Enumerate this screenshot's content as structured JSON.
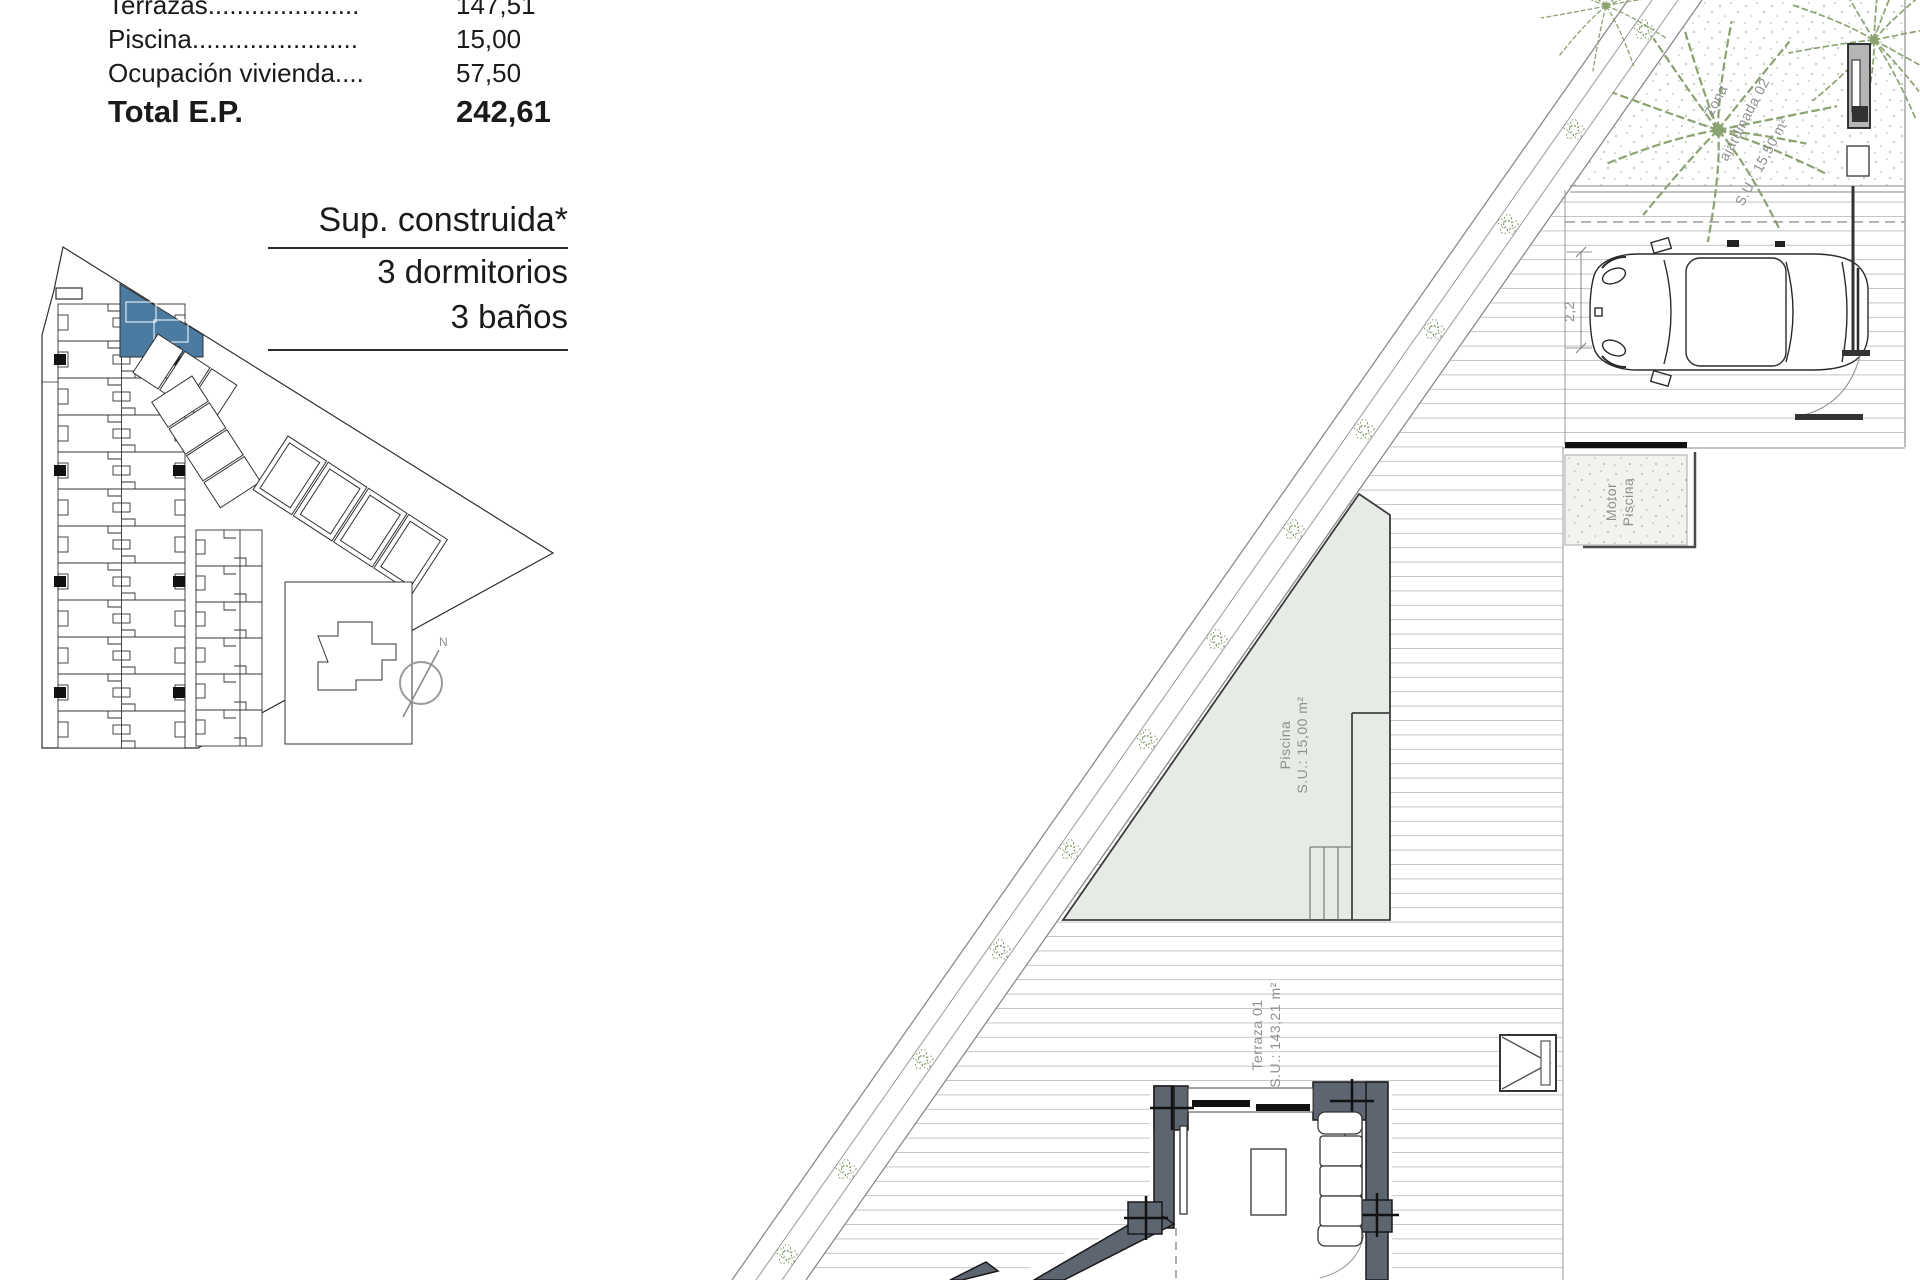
{
  "area_table": {
    "rows": [
      {
        "label": "Terrazas.....................",
        "value": "147,51"
      },
      {
        "label": "Piscina.......................",
        "value": "15,00"
      },
      {
        "label": "Ocupación vivienda....",
        "value": "57,50"
      }
    ],
    "total_label": "Total E.P.",
    "total_value": "242,61"
  },
  "summary": {
    "title": "Sup. construida*",
    "line1": "3 dormitorios",
    "line2": "3 baños"
  },
  "site_plan": {
    "north_label": "N"
  },
  "floor_plan": {
    "garden_label": {
      "l1": "Zona",
      "l2": "ajardinada 02",
      "l3": "S.U.: 15,50 m²"
    },
    "carport_dim": "2,2",
    "pool_equip": {
      "l1": "Motor",
      "l2": "Piscina"
    },
    "pool_label": {
      "l1": "Piscina",
      "l2": "S.U.: 15,00 m²"
    },
    "terrace_label": {
      "l1": "Terraza 01",
      "l2": "S.U.: 143,21 m²"
    }
  },
  "colors": {
    "highlight_unit": "#4b7ba0",
    "wall_gray": "#5d6570",
    "vegetation_green": "#8ba271",
    "deck_line": "#c5c5c5",
    "pool_fill": "#e7ebe6"
  }
}
